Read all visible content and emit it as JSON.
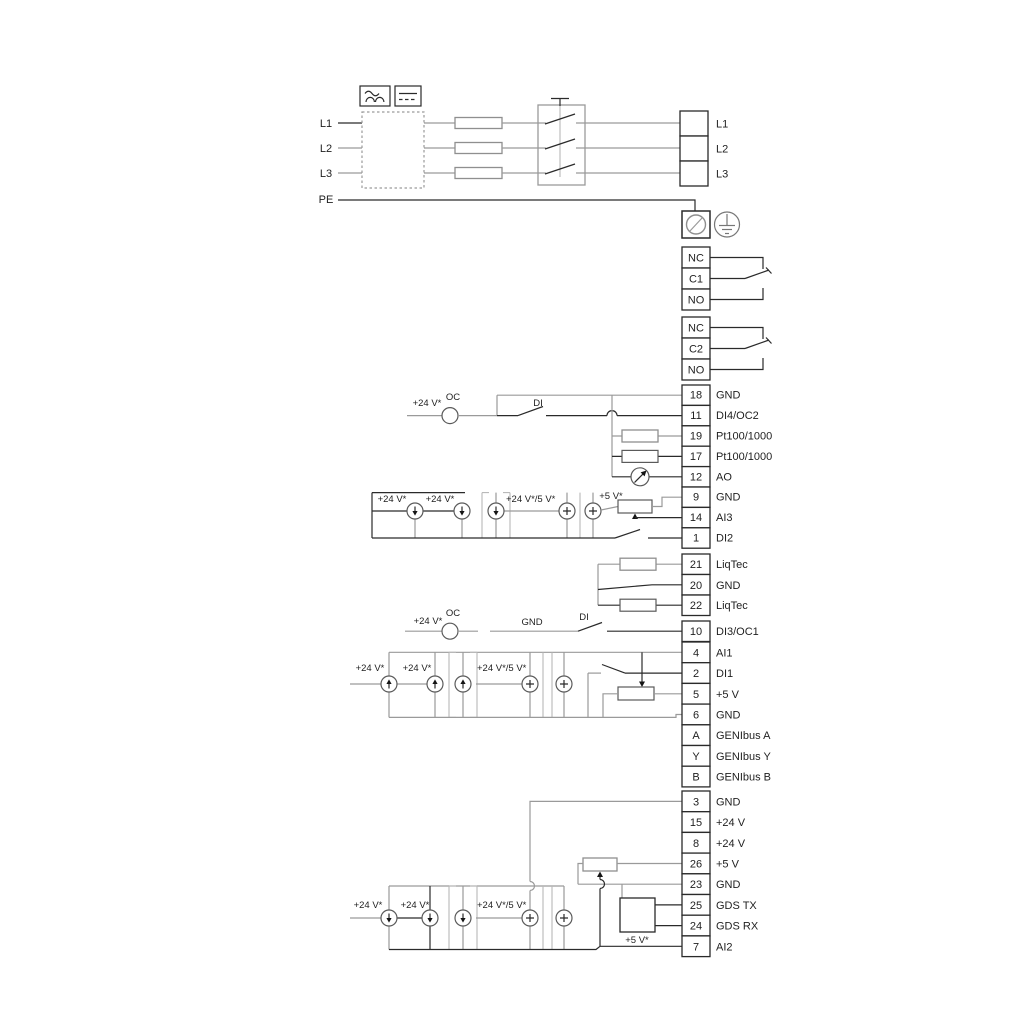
{
  "labels": {
    "v24": "+24 V*",
    "v24_5": "+24 V*/5 V*",
    "v5": "+5 V*",
    "oc": "OC",
    "di": "DI",
    "gnd": "GND"
  },
  "power": {
    "left": [
      "L1",
      "L2",
      "L3",
      "PE"
    ],
    "right": [
      "L1",
      "L2",
      "L3"
    ]
  },
  "relays": {
    "r1": [
      "NC",
      "C1",
      "NO"
    ],
    "r2": [
      "NC",
      "C2",
      "NO"
    ]
  },
  "terminals": {
    "io1": [
      {
        "num": "18",
        "label": "GND"
      },
      {
        "num": "11",
        "label": "DI4/OC2"
      },
      {
        "num": "19",
        "label": "Pt100/1000"
      },
      {
        "num": "17",
        "label": "Pt100/1000"
      },
      {
        "num": "12",
        "label": "AO"
      },
      {
        "num": "9",
        "label": "GND"
      },
      {
        "num": "14",
        "label": "AI3"
      },
      {
        "num": "1",
        "label": "DI2"
      }
    ],
    "liqtec": [
      {
        "num": "21",
        "label": "LiqTec"
      },
      {
        "num": "20",
        "label": "GND"
      },
      {
        "num": "22",
        "label": "LiqTec"
      }
    ],
    "di3": [
      {
        "num": "10",
        "label": "DI3/OC1"
      }
    ],
    "io2": [
      {
        "num": "4",
        "label": "AI1"
      },
      {
        "num": "2",
        "label": "DI1"
      },
      {
        "num": "5",
        "label": "+5 V"
      },
      {
        "num": "6",
        "label": "GND"
      },
      {
        "num": "A",
        "label": "GENIbus A"
      },
      {
        "num": "Y",
        "label": "GENIbus Y"
      },
      {
        "num": "B",
        "label": "GENIbus B"
      }
    ],
    "io3": [
      {
        "num": "3",
        "label": "GND"
      },
      {
        "num": "15",
        "label": "+24 V"
      },
      {
        "num": "8",
        "label": "+24 V"
      },
      {
        "num": "26",
        "label": "+5 V"
      },
      {
        "num": "23",
        "label": "GND"
      },
      {
        "num": "25",
        "label": "GDS TX"
      },
      {
        "num": "24",
        "label": "GDS RX"
      },
      {
        "num": "7",
        "label": "AI2"
      }
    ]
  }
}
